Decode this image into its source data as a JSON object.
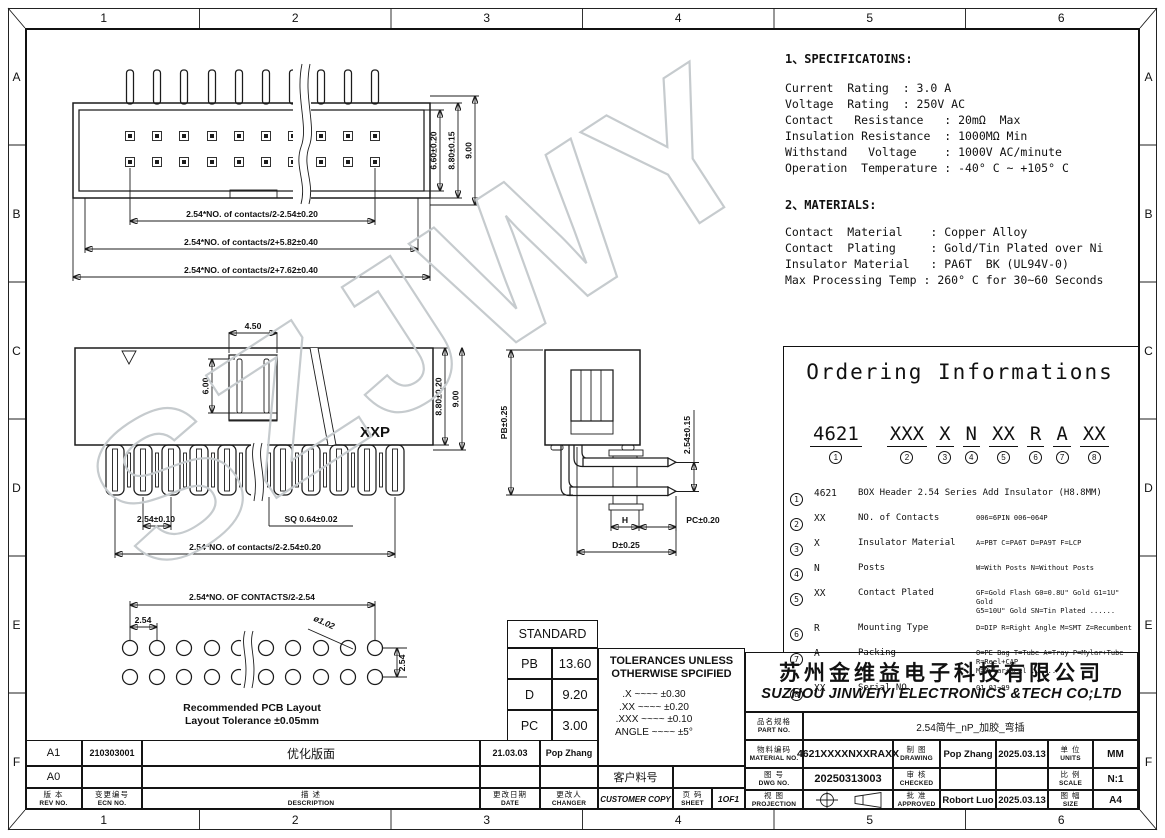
{
  "frame": {
    "cols": [
      "1",
      "2",
      "3",
      "4",
      "5",
      "6"
    ],
    "rows": [
      "A",
      "B",
      "C",
      "D",
      "E",
      "F"
    ]
  },
  "watermark": "SZJWY",
  "specifications": {
    "title": "1、SPECIFICATOINS:",
    "lines": [
      "Current  Rating  : 3.0 A",
      "Voltage  Rating  : 250V AC",
      "Contact   Resistance   : 20mΩ  Max",
      "Insulation Resistance  : 1000MΩ Min",
      "Withstand   Voltage    : 1000V AC/minute",
      "Operation  Temperature : -40° C ~ +105° C"
    ]
  },
  "materials": {
    "title": "2、MATERIALS:",
    "lines": [
      "Contact  Material    : Copper Alloy",
      "Contact  Plating     : Gold/Tin Plated over Ni",
      "Insulator Material   : PA6T  BK (UL94V-0)",
      "Max Processing Temp : 260° C for 30~60 Seconds"
    ]
  },
  "ordering": {
    "title": "Ordering Informations",
    "groups": [
      {
        "code": "4621",
        "num": "1"
      },
      {
        "code": "XXX",
        "num": "2"
      },
      {
        "code": "X",
        "num": "3"
      },
      {
        "code": "N",
        "num": "4"
      },
      {
        "code": "XX",
        "num": "5"
      },
      {
        "code": "R",
        "num": "6"
      },
      {
        "code": "A",
        "num": "7"
      },
      {
        "code": "XX",
        "num": "8"
      }
    ],
    "items": [
      {
        "num": "1",
        "code": "4621",
        "name": "BOX Header 2.54  Series  Add Insulator (H8.8MM)",
        "options": ""
      },
      {
        "num": "2",
        "code": "XX",
        "name": "NO. of Contacts",
        "options": "006=6PIN  006~064P"
      },
      {
        "num": "3",
        "code": "X",
        "name": "Insulator Material",
        "options": "A=PBT C=PA6T  D=PA9T  F=LCP"
      },
      {
        "num": "4",
        "code": "N",
        "name": "Posts",
        "options": "W=With Posts  N=Without Posts"
      },
      {
        "num": "5",
        "code": "XX",
        "name": "Contact Plated",
        "options": "GF=Gold Flash  G0=0.8U\" Gold  G1=1U\" Gold\nG5=10U\" Gold   SN=Tin Plated ......"
      },
      {
        "num": "6",
        "code": "R",
        "name": "Mounting Type",
        "options": "D=DIP  R=Right Angle  M=SMT  Z=Recumbent"
      },
      {
        "num": "7",
        "code": "A",
        "name": "Packing",
        "options": "O=PE Bag T=Tube A=Tray P=Mylar+Tube R=Reel+CAP\nM=Mylar+Reel ......"
      },
      {
        "num": "8",
        "code": "XX",
        "name": "Serial NO.",
        "options": "01    01~99"
      }
    ]
  },
  "views": {
    "top": {
      "w1": "2.54*NO. of contacts/2-2.54±0.20",
      "w2": "2.54*NO. of contacts/2+5.82±0.40",
      "w3": "2.54*NO. of contacts/2+7.62±0.40",
      "h1": "6.60±0.20",
      "h2": "8.80±0.15",
      "h3": "9.00"
    },
    "front": {
      "slot_w": "4.50",
      "slot_h": "6.00",
      "label": "XXP",
      "h1": "8.80±0.20",
      "h2": "9.00",
      "pitch": "2.54±0.10",
      "sq": "SQ 0.64±0.02",
      "w1": "2.54*NO. of contacts/2-2.54±0.20"
    },
    "side": {
      "pb": "PB±0.25",
      "pin": "2.54±0.15",
      "h": "H",
      "pc": "PC±0.20",
      "d": "D±0.25"
    },
    "pcb": {
      "w1": "2.54*NO. OF CONTACTS/2-2.54",
      "pitch": "2.54",
      "hole": "ø1.02",
      "row": "2.54",
      "cap1": "Recommended PCB Layout",
      "cap2": "Layout Tolerance ±0.05mm"
    }
  },
  "standard": {
    "title": "STANDARD",
    "rows": [
      {
        "k": "PB",
        "v": "13.60"
      },
      {
        "k": "D",
        "v": "9.20"
      },
      {
        "k": "PC",
        "v": "3.00"
      }
    ]
  },
  "tolerances": {
    "line1": "TOLERANCES UNLESS",
    "line2": "OTHERWISE SPCIFIED",
    "items": [
      ".X ~~~~ ±0.30",
      ".XX ~~~~ ±0.20",
      ".XXX ~~~~ ±0.10",
      "ANGLE ~~~~ ±5°"
    ]
  },
  "company": {
    "cn": "苏州金维益电子科技有限公司",
    "en": "SUZHOU JINWEIYI ELECTRONICS &TECH CO;LTD"
  },
  "title_block": {
    "part": {
      "cn": "品名规格",
      "en": "PART NO.",
      "value": "2.54简牛_nP_加胶_弯插"
    },
    "material": {
      "cn": "物料编码",
      "en": "MATERIAL NO.",
      "value": "4621XXXXNXXRAXX"
    },
    "drawing": {
      "cn": "制 图",
      "en": "DRAWING",
      "value": "Pop Zhang",
      "date": "2025.03.13"
    },
    "units": {
      "cn": "单 位",
      "en": "UNITS",
      "value": "MM"
    },
    "dwg": {
      "cn": "图 号",
      "en": "DWG NO.",
      "value": "20250313003"
    },
    "checked": {
      "cn": "审 核",
      "en": "CHECKED",
      "value": "",
      "date": ""
    },
    "scale": {
      "cn": "比 例",
      "en": "SCALE",
      "value": "N:1"
    },
    "projection": {
      "cn": "视 图",
      "en": "PROJECTION"
    },
    "approved": {
      "cn": "批 准",
      "en": "APPROVED",
      "value": "Robort Luo",
      "date": "2025.03.13"
    },
    "size": {
      "cn": "图 幅",
      "en": "SIZE",
      "value": "A4"
    }
  },
  "revisions": {
    "rows": [
      {
        "rev": "A1",
        "ecn": "210303001",
        "desc": "优化版面",
        "date": "21.03.03",
        "changer": "Pop Zhang"
      },
      {
        "rev": "A0",
        "ecn": "",
        "desc": "",
        "date": "",
        "changer": ""
      }
    ],
    "header": {
      "rev_cn": "版 本",
      "rev_en": "REV NO.",
      "ecn_cn": "变更编号",
      "ecn_en": "ECN NO.",
      "desc_cn": "描 述",
      "desc_en": "DESCRIPTION",
      "date_cn": "更改日期",
      "date_en": "DATE",
      "changer_cn": "更改人",
      "changer_en": "CHANGER"
    },
    "customer_label": "客户料号",
    "customer_copy": "CUSTOMER COPY",
    "sheet": {
      "cn": "页 码",
      "en": "SHEET",
      "value": "1OF1"
    }
  }
}
